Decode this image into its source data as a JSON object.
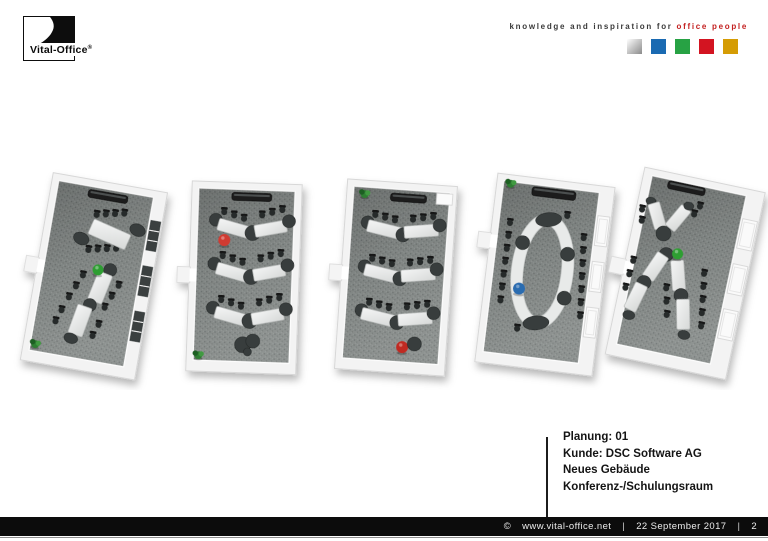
{
  "logo": {
    "brand": "Vital-Office",
    "reg": "®"
  },
  "tagline": {
    "black": "knowledge and inspiration for",
    "red": "office people"
  },
  "palette": {
    "squares": [
      {
        "name": "silver",
        "gradient": [
          "#ffffff",
          "#c9c9c9",
          "#8b8b8b"
        ]
      },
      {
        "name": "blue",
        "color": "#1a6ab2"
      },
      {
        "name": "green",
        "color": "#27a244"
      },
      {
        "name": "red",
        "color": "#d31421"
      },
      {
        "name": "gold",
        "color": "#d59c04"
      }
    ]
  },
  "info": {
    "lines": [
      "Planung: 01",
      "Kunde: DSC Software AG",
      "Neues Gebäude",
      "Konferenz-/Schulungsraum"
    ]
  },
  "footer": {
    "copyright": "©",
    "url": "www.vital-office.net",
    "sep": "|",
    "date": "22 September 2017",
    "page": "2"
  },
  "scene_colors": {
    "carpet": "#878c8a",
    "wall": "#f3f3f3",
    "table": "#e9ebea",
    "chair": "#262a29",
    "accent_green": "#2f9e33",
    "accent_red": "#d03a30",
    "accent_blue": "#2a6cb0",
    "dark_node": "#383d3c"
  },
  "floorplans": [
    {
      "name": "variant-1-two-long-tables",
      "rotation": 10,
      "origin": [
        28,
        14
      ],
      "shell": {
        "wl": 7,
        "wt": 7,
        "wr": 13,
        "wb": 11,
        "doorY": 92,
        "windows": "dark"
      },
      "items": [
        {
          "t": "bar",
          "x": 46,
          "y": 16,
          "w": 40,
          "h": 8
        },
        {
          "t": "chairs",
          "x": 58,
          "y": 40,
          "n": 4,
          "dx": 9,
          "dy": -2
        },
        {
          "t": "chairs",
          "x": 56,
          "y": 76,
          "n": 4,
          "dx": 9,
          "dy": -2
        },
        {
          "t": "cap",
          "x": 47,
          "y": 66,
          "rx": 8,
          "ry": 6,
          "r": 14
        },
        {
          "t": "table",
          "x": 74,
          "y": 57,
          "w": 40,
          "h": 16,
          "r": 14
        },
        {
          "t": "cap",
          "x": 101,
          "y": 48,
          "rx": 8,
          "ry": 6,
          "r": 14
        },
        {
          "t": "chairs",
          "x": 55,
          "y": 102,
          "n": 3,
          "dx": -5,
          "dy": 12
        },
        {
          "t": "chairs",
          "x": 92,
          "y": 106,
          "n": 3,
          "dx": -5,
          "dy": 12
        },
        {
          "t": "chairs",
          "x": 40,
          "y": 140,
          "n": 2,
          "dx": -4,
          "dy": 12
        },
        {
          "t": "chairs",
          "x": 79,
          "y": 148,
          "n": 2,
          "dx": -4,
          "dy": 12
        },
        {
          "t": "node",
          "x": 81,
          "y": 92,
          "r": 6.5
        },
        {
          "t": "table",
          "x": 74,
          "y": 111,
          "w": 15,
          "h": 30,
          "r": 12
        },
        {
          "t": "node",
          "x": 67,
          "y": 130,
          "r": 6.5
        },
        {
          "t": "table",
          "x": 60,
          "y": 147,
          "w": 15,
          "h": 30,
          "r": 10
        },
        {
          "t": "cap",
          "x": 54,
          "y": 166,
          "rx": 7,
          "ry": 5,
          "r": 10
        },
        {
          "t": "ball",
          "x": 69,
          "y": 94,
          "c": "#2f9e33",
          "r": 5.5
        },
        {
          "t": "plant",
          "x": 20,
          "y": 178
        }
      ]
    },
    {
      "name": "variant-2-chevron-rows",
      "rotation": 2,
      "origin": [
        181,
        15
      ],
      "shell": {
        "wl": 7,
        "wt": 7,
        "wr": 7,
        "wb": 11,
        "doorY": 92,
        "windows": null
      },
      "items": [
        {
          "t": "bar",
          "x": 48,
          "y": 16,
          "w": 40,
          "h": 8
        },
        {
          "t": "chairs",
          "x": 41,
          "y": 36,
          "n": 3,
          "dx": 10,
          "dy": 3
        },
        {
          "t": "chairs",
          "x": 79,
          "y": 38,
          "n": 3,
          "dx": 10,
          "dy": -3
        },
        {
          "t": "cap",
          "x": 33,
          "y": 44,
          "rx": 6.5,
          "ry": 6.5
        },
        {
          "t": "table",
          "x": 51,
          "y": 52,
          "w": 32,
          "h": 12,
          "r": 14
        },
        {
          "t": "node",
          "x": 70,
          "y": 56,
          "r": 7.5
        },
        {
          "t": "table",
          "x": 88,
          "y": 51,
          "w": 32,
          "h": 12,
          "r": -12
        },
        {
          "t": "cap",
          "x": 106,
          "y": 43,
          "rx": 6.5,
          "ry": 6.5
        },
        {
          "t": "chairs",
          "x": 41,
          "y": 80,
          "n": 3,
          "dx": 10,
          "dy": 3
        },
        {
          "t": "chairs",
          "x": 79,
          "y": 82,
          "n": 3,
          "dx": 10,
          "dy": -3
        },
        {
          "t": "cap",
          "x": 33,
          "y": 88,
          "rx": 6.5,
          "ry": 6.5
        },
        {
          "t": "table",
          "x": 51,
          "y": 96,
          "w": 32,
          "h": 12,
          "r": 14
        },
        {
          "t": "node",
          "x": 70,
          "y": 100,
          "r": 7.5
        },
        {
          "t": "table",
          "x": 88,
          "y": 95,
          "w": 32,
          "h": 12,
          "r": -12
        },
        {
          "t": "cap",
          "x": 106,
          "y": 87,
          "rx": 6.5,
          "ry": 6.5
        },
        {
          "t": "chairs",
          "x": 41,
          "y": 124,
          "n": 3,
          "dx": 10,
          "dy": 3
        },
        {
          "t": "chairs",
          "x": 79,
          "y": 126,
          "n": 3,
          "dx": 10,
          "dy": -3
        },
        {
          "t": "cap",
          "x": 33,
          "y": 132,
          "rx": 6.5,
          "ry": 6.5
        },
        {
          "t": "table",
          "x": 51,
          "y": 140,
          "w": 32,
          "h": 12,
          "r": 14
        },
        {
          "t": "node",
          "x": 70,
          "y": 144,
          "r": 7.5
        },
        {
          "t": "table",
          "x": 88,
          "y": 139,
          "w": 32,
          "h": 12,
          "r": -12
        },
        {
          "t": "cap",
          "x": 106,
          "y": 131,
          "rx": 6.5,
          "ry": 6.5
        },
        {
          "t": "ball",
          "x": 42,
          "y": 64,
          "c": "#d03a30",
          "r": 6
        },
        {
          "t": "node",
          "x": 64,
          "y": 168,
          "r": 8
        },
        {
          "t": "node",
          "x": 74,
          "y": 164,
          "r": 7
        },
        {
          "t": "node",
          "x": 69,
          "y": 175,
          "r": 4
        },
        {
          "t": "plant",
          "x": 20,
          "y": 180
        }
      ]
    },
    {
      "name": "variant-3-classroom-rows",
      "rotation": 4,
      "origin": [
        333,
        15
      ],
      "shell": {
        "wl": 7,
        "wt": 7,
        "wr": 7,
        "wb": 11,
        "doorY": 92,
        "windows": null
      },
      "items": [
        {
          "t": "plant",
          "x": 26,
          "y": 20
        },
        {
          "t": "bar",
          "x": 52,
          "y": 17,
          "w": 36,
          "h": 8
        },
        {
          "t": "box",
          "x": 98,
          "y": 14,
          "w": 16,
          "h": 11
        },
        {
          "t": "chairs",
          "x": 38,
          "y": 40,
          "n": 3,
          "dx": 10,
          "dy": 2
        },
        {
          "t": "chairs",
          "x": 76,
          "y": 42,
          "n": 3,
          "dx": 10,
          "dy": -2
        },
        {
          "t": "cap",
          "x": 31,
          "y": 48,
          "rx": 6.5,
          "ry": 6.5
        },
        {
          "t": "table",
          "x": 48,
          "y": 54,
          "w": 34,
          "h": 12,
          "r": 10
        },
        {
          "t": "node",
          "x": 67,
          "y": 58,
          "r": 7
        },
        {
          "t": "table",
          "x": 85,
          "y": 53,
          "w": 34,
          "h": 12,
          "r": -8
        },
        {
          "t": "cap",
          "x": 103,
          "y": 46,
          "rx": 6.5,
          "ry": 6.5
        },
        {
          "t": "chairs",
          "x": 38,
          "y": 84,
          "n": 3,
          "dx": 10,
          "dy": 2
        },
        {
          "t": "chairs",
          "x": 76,
          "y": 86,
          "n": 3,
          "dx": 10,
          "dy": -2
        },
        {
          "t": "cap",
          "x": 31,
          "y": 92,
          "rx": 6.5,
          "ry": 6.5
        },
        {
          "t": "table",
          "x": 48,
          "y": 98,
          "w": 34,
          "h": 12,
          "r": 10
        },
        {
          "t": "node",
          "x": 67,
          "y": 102,
          "r": 7
        },
        {
          "t": "table",
          "x": 85,
          "y": 97,
          "w": 34,
          "h": 12,
          "r": -8
        },
        {
          "t": "cap",
          "x": 103,
          "y": 90,
          "rx": 6.5,
          "ry": 6.5
        },
        {
          "t": "chairs",
          "x": 38,
          "y": 128,
          "n": 3,
          "dx": 10,
          "dy": 2
        },
        {
          "t": "chairs",
          "x": 76,
          "y": 130,
          "n": 3,
          "dx": 10,
          "dy": -2
        },
        {
          "t": "cap",
          "x": 31,
          "y": 136,
          "rx": 6.5,
          "ry": 6.5
        },
        {
          "t": "table",
          "x": 48,
          "y": 142,
          "w": 34,
          "h": 12,
          "r": 10
        },
        {
          "t": "node",
          "x": 67,
          "y": 146,
          "r": 7
        },
        {
          "t": "table",
          "x": 85,
          "y": 141,
          "w": 34,
          "h": 12,
          "r": -8
        },
        {
          "t": "cap",
          "x": 103,
          "y": 134,
          "rx": 6.5,
          "ry": 6.5
        },
        {
          "t": "ball",
          "x": 74,
          "y": 170,
          "c": "#c02a20",
          "r": 6
        },
        {
          "t": "node",
          "x": 86,
          "y": 166,
          "r": 7
        }
      ]
    },
    {
      "name": "variant-4-oval-conference",
      "rotation": 7,
      "origin": [
        478,
        12
      ],
      "shell": {
        "wl": 7,
        "wt": 7,
        "wr": 15,
        "wb": 11,
        "doorY": 66,
        "windows": "light"
      },
      "items": [
        {
          "t": "bar",
          "x": 44,
          "y": 15,
          "w": 44,
          "h": 9
        },
        {
          "t": "plant",
          "x": 22,
          "y": 15
        },
        {
          "t": "chairs",
          "x": 26,
          "y": 54,
          "n": 7,
          "dx": 0,
          "dy": 13
        },
        {
          "t": "chairs",
          "x": 101,
          "y": 60,
          "n": 7,
          "dx": 1,
          "dy": 13
        },
        {
          "t": "chair",
          "x": 82,
          "y": 40
        },
        {
          "t": "chair",
          "x": 46,
          "y": 158
        },
        {
          "t": "oval",
          "x": 64,
          "y": 98,
          "rx": 25,
          "ry": 52
        },
        {
          "t": "cap",
          "x": 64,
          "y": 46,
          "rx": 13,
          "ry": 7,
          "r": -12
        },
        {
          "t": "cap",
          "x": 64,
          "y": 150,
          "rx": 13,
          "ry": 7,
          "r": -12
        },
        {
          "t": "node",
          "x": 41,
          "y": 72,
          "r": 7
        },
        {
          "t": "node",
          "x": 87,
          "y": 78,
          "r": 7
        },
        {
          "t": "node",
          "x": 89,
          "y": 122,
          "r": 7
        },
        {
          "t": "ball",
          "x": 43,
          "y": 118,
          "c": "#2a6cb0",
          "r": 6
        }
      ]
    },
    {
      "name": "variant-5-y-tables",
      "rotation": 12,
      "origin": [
        616,
        10
      ],
      "shell": {
        "wl": 9,
        "wt": 7,
        "wr": 18,
        "wb": 12,
        "doorY": 100,
        "windows": "light"
      },
      "items": [
        {
          "t": "bar",
          "x": 34,
          "y": 14,
          "w": 38,
          "h": 8
        },
        {
          "t": "chairs",
          "x": 14,
          "y": 48,
          "n": 2,
          "dx": 2,
          "dy": 11
        },
        {
          "t": "chairs",
          "x": 66,
          "y": 42,
          "n": 2,
          "dx": 4,
          "dy": -9
        },
        {
          "t": "cap",
          "x": 21,
          "y": 38,
          "rx": 5,
          "ry": 4
        },
        {
          "t": "table",
          "x": 30,
          "y": 51,
          "w": 12,
          "h": 26,
          "r": -28
        },
        {
          "t": "node",
          "x": 40,
          "y": 67,
          "r": 7.5
        },
        {
          "t": "table",
          "x": 51,
          "y": 49,
          "w": 12,
          "h": 26,
          "r": 28
        },
        {
          "t": "cap",
          "x": 59,
          "y": 35,
          "rx": 5,
          "ry": 4
        },
        {
          "t": "chairs",
          "x": 16,
          "y": 100,
          "n": 3,
          "dx": -1,
          "dy": 14
        },
        {
          "t": "chairs",
          "x": 88,
          "y": 98,
          "n": 5,
          "dx": 2,
          "dy": 13
        },
        {
          "t": "chairs",
          "x": 54,
          "y": 120,
          "n": 3,
          "dx": 3,
          "dy": 13
        },
        {
          "t": "node",
          "x": 47,
          "y": 87,
          "r": 7
        },
        {
          "t": "table",
          "x": 39,
          "y": 101,
          "w": 13,
          "h": 28,
          "r": 22
        },
        {
          "t": "node",
          "x": 31,
          "y": 119,
          "r": 7
        },
        {
          "t": "table",
          "x": 26,
          "y": 135,
          "w": 13,
          "h": 28,
          "r": 14
        },
        {
          "t": "cap",
          "x": 23,
          "y": 154,
          "rx": 6,
          "ry": 4.5
        },
        {
          "t": "table",
          "x": 63,
          "y": 105,
          "w": 13,
          "h": 30,
          "r": -16
        },
        {
          "t": "node",
          "x": 70,
          "y": 124,
          "r": 7
        },
        {
          "t": "table",
          "x": 76,
          "y": 142,
          "w": 13,
          "h": 30,
          "r": -13
        },
        {
          "t": "cap",
          "x": 81,
          "y": 162,
          "rx": 6,
          "ry": 4.5
        },
        {
          "t": "ball",
          "x": 58,
          "y": 84,
          "c": "#2f9e33",
          "r": 5.5
        }
      ]
    }
  ]
}
